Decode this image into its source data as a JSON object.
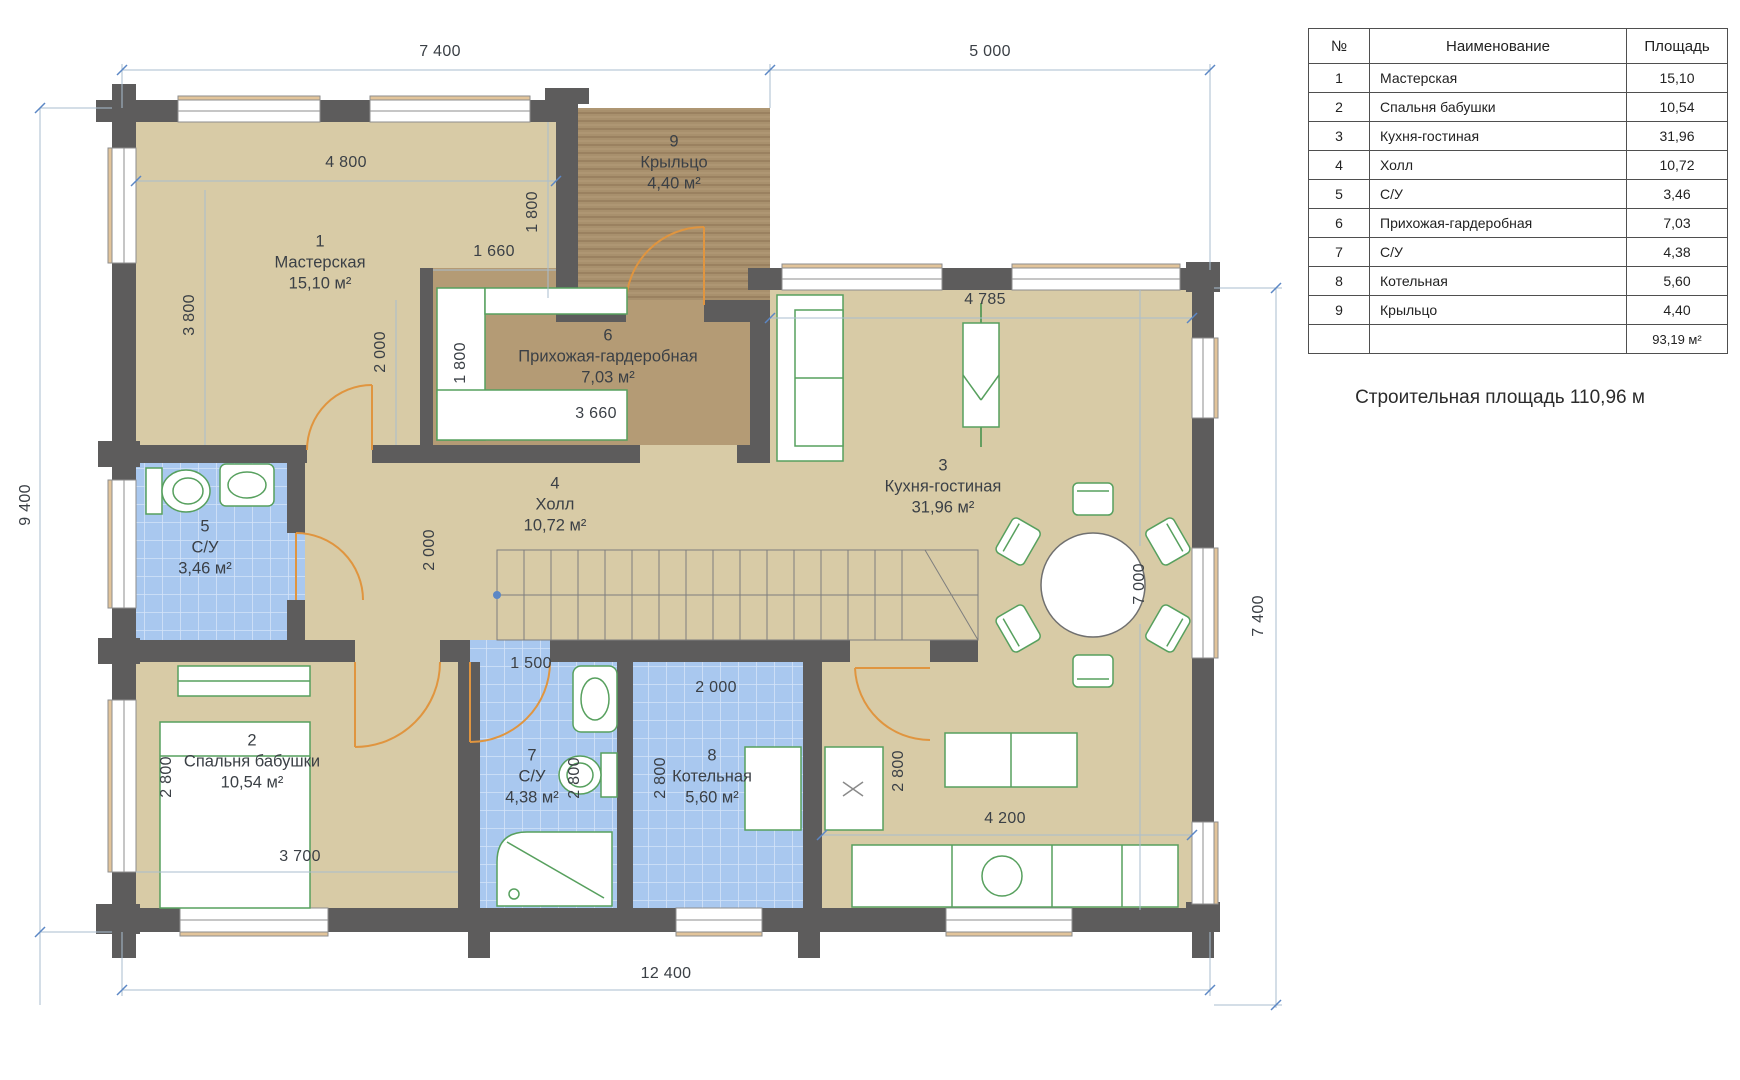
{
  "summary": "Строительная площадь 110,96 м",
  "legend": {
    "col_num": "№",
    "col_name": "Наименование",
    "col_area": "Площадь",
    "rows": [
      {
        "num": "1",
        "name": "Мастерская",
        "area": "15,10"
      },
      {
        "num": "2",
        "name": "Спальня бабушки",
        "area": "10,54"
      },
      {
        "num": "3",
        "name": "Кухня-гостиная",
        "area": "31,96"
      },
      {
        "num": "4",
        "name": "Холл",
        "area": "10,72"
      },
      {
        "num": "5",
        "name": "С/У",
        "area": "3,46"
      },
      {
        "num": "6",
        "name": "Прихожая-гардеробная",
        "area": "7,03"
      },
      {
        "num": "7",
        "name": "С/У",
        "area": "4,38"
      },
      {
        "num": "8",
        "name": "Котельная",
        "area": "5,60"
      },
      {
        "num": "9",
        "name": "Крыльцо",
        "area": "4,40"
      }
    ],
    "total": "93,19 м²"
  },
  "rooms": [
    {
      "num": "1",
      "name": "Мастерская",
      "area": "15,10 м²"
    },
    {
      "num": "2",
      "name": "Спальня бабушки",
      "area": "10,54 м²"
    },
    {
      "num": "3",
      "name": "Кухня-гостиная",
      "area": "31,96 м²"
    },
    {
      "num": "4",
      "name": "Холл",
      "area": "10,72 м²"
    },
    {
      "num": "5",
      "name": "С/У",
      "area": "3,46 м²"
    },
    {
      "num": "6",
      "name": "Прихожая-гардеробная",
      "area": "7,03 м²"
    },
    {
      "num": "7",
      "name": "С/У",
      "area": "4,38 м²"
    },
    {
      "num": "8",
      "name": "Котельная",
      "area": "5,60 м²"
    },
    {
      "num": "9",
      "name": "Крыльцо",
      "area": "4,40 м²"
    }
  ],
  "dims": {
    "top_left": "7 400",
    "top_right": "5 000",
    "left": "9 400",
    "right": "7 400",
    "bottom": "12 400",
    "room1_width": "4 800",
    "room1_height": "3 800",
    "room1_inner": "2 000",
    "room1_niche": "1 660",
    "porch_depth": "1 800",
    "wardrobe": "1 800",
    "hallway_width": "3 660",
    "hall_depth": "2 000",
    "kitchen_top": "4 785",
    "kitchen_height": "7 000",
    "bedroom_height": "2 800",
    "bedroom_width": "3 700",
    "bath7_width": "1 500",
    "bath7_height": "2 800",
    "boiler_width": "2 000",
    "boiler_height": "2 800",
    "fridge_gap": "2 800",
    "counter_width": "4 200"
  },
  "colors": {
    "wall": "#5d5c5c",
    "floor": "#d8cba6",
    "porch": "#a8906d",
    "hallway_floor": "#b49b75",
    "tile": "#a9c8ef",
    "furniture_outline": "#57a05e",
    "door_arc": "#e0953f",
    "dim_line": "#a9becf",
    "dim_tick": "#5b87c5",
    "text": "#3b4046"
  }
}
